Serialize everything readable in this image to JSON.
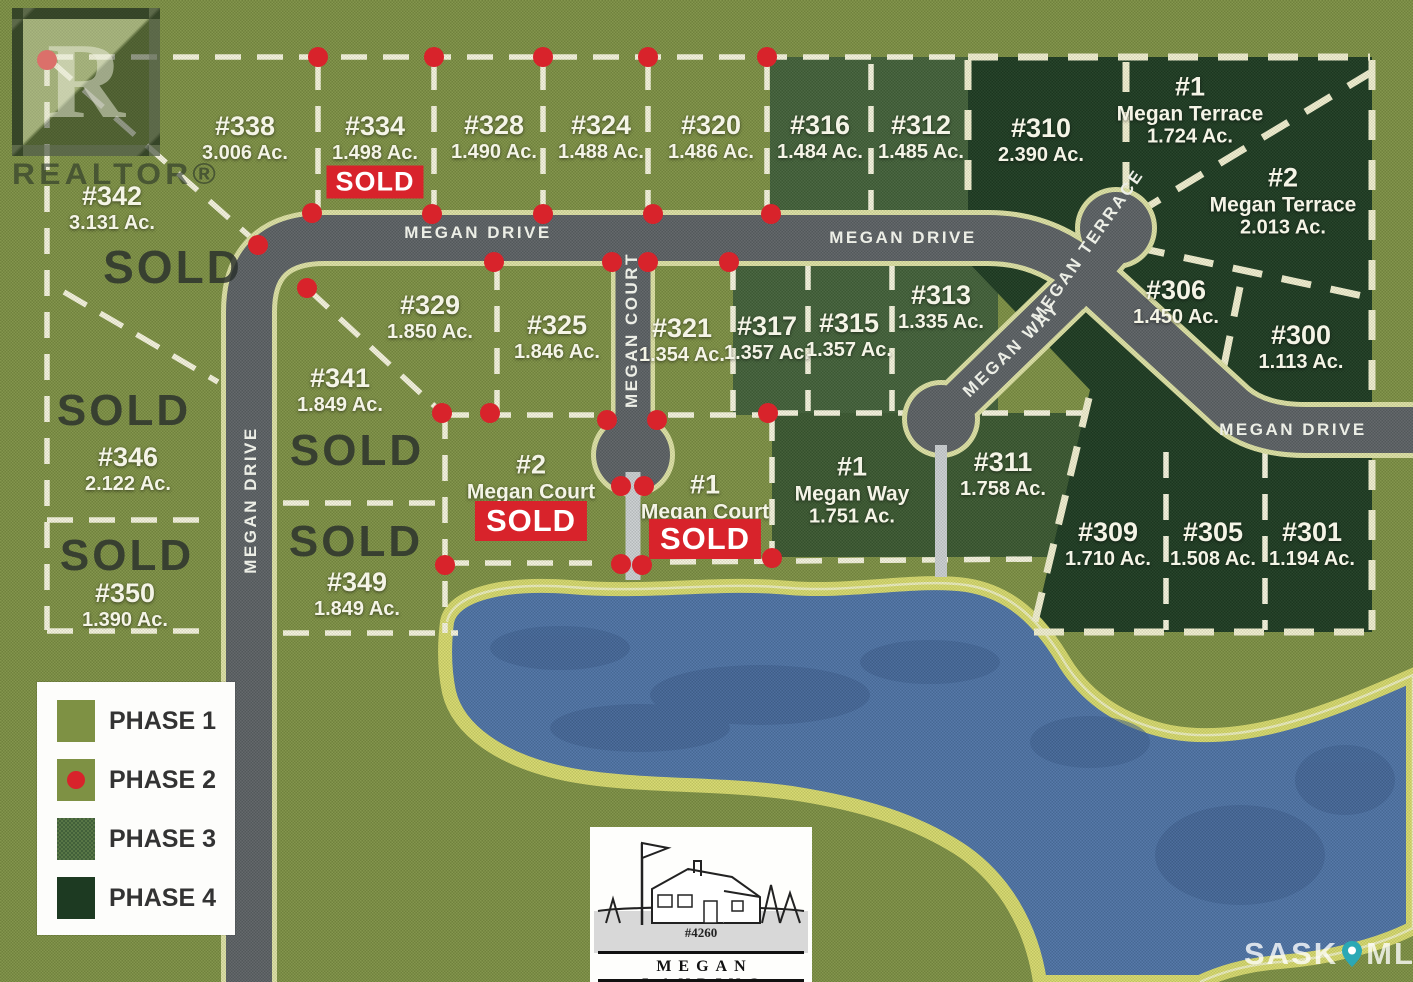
{
  "map": {
    "road_labels": [
      {
        "id": "megan-drive-top-left",
        "label": "MEGAN DRIVE",
        "x": 478,
        "y": 233,
        "rot": 0
      },
      {
        "id": "megan-drive-top-right",
        "label": "MEGAN DRIVE",
        "x": 903,
        "y": 238,
        "rot": 0
      },
      {
        "id": "megan-drive-right",
        "label": "MEGAN DRIVE",
        "x": 1293,
        "y": 430,
        "rot": 0
      },
      {
        "id": "megan-drive-west",
        "label": "MEGAN DRIVE",
        "x": 251,
        "y": 500,
        "rot": -90
      },
      {
        "id": "megan-court",
        "label": "MEGAN COURT",
        "x": 632,
        "y": 330,
        "rot": -90
      },
      {
        "id": "megan-way",
        "label": "MEGAN WAY",
        "x": 1012,
        "y": 350,
        "rot": -44
      },
      {
        "id": "megan-terrace",
        "label": "MEGAN TERRACE",
        "x": 1088,
        "y": 246,
        "rot": -55
      }
    ],
    "lots": [
      {
        "id": "342",
        "lines": [
          "#342",
          "3.131 Ac."
        ],
        "x": 112,
        "y": 208
      },
      {
        "id": "338",
        "lines": [
          "#338",
          "3.006 Ac."
        ],
        "x": 245,
        "y": 138
      },
      {
        "id": "334",
        "lines": [
          "#334",
          "1.498 Ac."
        ],
        "x": 375,
        "y": 138,
        "sold": "SOLD",
        "sold_dy": 44
      },
      {
        "id": "328",
        "lines": [
          "#328",
          "1.490 Ac."
        ],
        "x": 494,
        "y": 137
      },
      {
        "id": "324",
        "lines": [
          "#324",
          "1.488 Ac."
        ],
        "x": 601,
        "y": 137
      },
      {
        "id": "320",
        "lines": [
          "#320",
          "1.486 Ac."
        ],
        "x": 711,
        "y": 137
      },
      {
        "id": "316",
        "lines": [
          "#316",
          "1.484 Ac."
        ],
        "x": 820,
        "y": 137
      },
      {
        "id": "312",
        "lines": [
          "#312",
          "1.485 Ac."
        ],
        "x": 921,
        "y": 137
      },
      {
        "id": "310",
        "lines": [
          "#310",
          "2.390 Ac."
        ],
        "x": 1041,
        "y": 140
      },
      {
        "id": "1-megan-terrace",
        "lines": [
          "#1",
          "Megan Terrace",
          "1.724 Ac."
        ],
        "x": 1190,
        "y": 110
      },
      {
        "id": "2-megan-terrace",
        "lines": [
          "#2",
          "Megan Terrace",
          "2.013 Ac."
        ],
        "x": 1283,
        "y": 201
      },
      {
        "id": "329",
        "lines": [
          "#329",
          "1.850 Ac."
        ],
        "x": 430,
        "y": 317
      },
      {
        "id": "341",
        "lines": [
          "#341",
          "1.849 Ac."
        ],
        "x": 340,
        "y": 390
      },
      {
        "id": "325",
        "lines": [
          "#325",
          "1.846 Ac."
        ],
        "x": 557,
        "y": 337
      },
      {
        "id": "321",
        "lines": [
          "#321",
          "1.354 Ac."
        ],
        "x": 682,
        "y": 340
      },
      {
        "id": "317",
        "lines": [
          "#317",
          "1.357 Ac."
        ],
        "x": 767,
        "y": 338
      },
      {
        "id": "315",
        "lines": [
          "#315",
          "1.357 Ac."
        ],
        "x": 849,
        "y": 335
      },
      {
        "id": "313",
        "lines": [
          "#313",
          "1.335 Ac."
        ],
        "x": 941,
        "y": 307
      },
      {
        "id": "306",
        "lines": [
          "#306",
          "1.450 Ac."
        ],
        "x": 1176,
        "y": 302
      },
      {
        "id": "300",
        "lines": [
          "#300",
          "1.113 Ac."
        ],
        "x": 1301,
        "y": 347
      },
      {
        "id": "346",
        "lines": [
          "#346",
          "2.122 Ac."
        ],
        "x": 128,
        "y": 469
      },
      {
        "id": "350",
        "lines": [
          "#350",
          "1.390 Ac."
        ],
        "x": 125,
        "y": 605
      },
      {
        "id": "349",
        "lines": [
          "#349",
          "1.849 Ac."
        ],
        "x": 357,
        "y": 594
      },
      {
        "id": "2-megan-court",
        "lines": [
          "#2",
          "Megan Court"
        ],
        "x": 531,
        "y": 477,
        "sold": "SOLD",
        "sold_dy": 44,
        "sold_big": true
      },
      {
        "id": "1-megan-court",
        "lines": [
          "#1",
          "Megan Court"
        ],
        "x": 705,
        "y": 497,
        "sold": "SOLD",
        "sold_dy": 42,
        "sold_big": true
      },
      {
        "id": "1-megan-way",
        "lines": [
          "#1",
          "Megan Way",
          "1.751 Ac."
        ],
        "x": 852,
        "y": 490
      },
      {
        "id": "311",
        "lines": [
          "#311",
          "1.758 Ac."
        ],
        "x": 1003,
        "y": 474
      },
      {
        "id": "309",
        "lines": [
          "#309",
          "1.710 Ac."
        ],
        "x": 1108,
        "y": 544
      },
      {
        "id": "305",
        "lines": [
          "#305",
          "1.508 Ac."
        ],
        "x": 1213,
        "y": 544
      },
      {
        "id": "301",
        "lines": [
          "#301",
          "1.194 Ac."
        ],
        "x": 1312,
        "y": 544
      }
    ],
    "sold_overlays": [
      {
        "text": "SOLD",
        "x": 173,
        "y": 267,
        "size": 46
      },
      {
        "text": "SOLD",
        "x": 124,
        "y": 411,
        "size": 44
      },
      {
        "text": "SOLD",
        "x": 357,
        "y": 451,
        "size": 44
      },
      {
        "text": "SOLD",
        "x": 127,
        "y": 556,
        "size": 44
      },
      {
        "text": "SOLD",
        "x": 356,
        "y": 542,
        "size": 44
      }
    ],
    "phase2_dots": [
      [
        47,
        60
      ],
      [
        318,
        57
      ],
      [
        434,
        57
      ],
      [
        543,
        57
      ],
      [
        648,
        57
      ],
      [
        767,
        57
      ],
      [
        312,
        213
      ],
      [
        432,
        214
      ],
      [
        543,
        214
      ],
      [
        653,
        214
      ],
      [
        771,
        214
      ],
      [
        258,
        245
      ],
      [
        307,
        288
      ],
      [
        494,
        262
      ],
      [
        612,
        262
      ],
      [
        648,
        262
      ],
      [
        729,
        262
      ],
      [
        442,
        413
      ],
      [
        490,
        413
      ],
      [
        607,
        420
      ],
      [
        657,
        420
      ],
      [
        768,
        413
      ],
      [
        621,
        486
      ],
      [
        644,
        486
      ],
      [
        445,
        565
      ],
      [
        621,
        564
      ],
      [
        642,
        565
      ],
      [
        772,
        558
      ]
    ]
  },
  "legend": {
    "items": [
      {
        "label": "PHASE 1",
        "phase": "phase1"
      },
      {
        "label": "PHASE 2",
        "phase": "phase2"
      },
      {
        "label": "PHASE 3",
        "phase": "phase3"
      },
      {
        "label": "PHASE 4",
        "phase": "phase4"
      }
    ]
  },
  "branding": {
    "realtor_letter": "R",
    "realtor": "REALTOR®",
    "logo_number": "#4260",
    "logo_name": "MEGAN LANDING",
    "watermark_sask": "SASK",
    "watermark_mls": "MLS",
    "watermark_reg": "®"
  },
  "colors": {
    "phase1": "#7e9144",
    "phase2_marker": "#d8232b",
    "phase3": "#42603a",
    "phase4": "#1d3a22",
    "road": "#5c6166",
    "road_edge": "#dfe2a6",
    "lake": "#4e73a8",
    "lake_border": "#d8da6e",
    "sold_red": "#d8232b",
    "dash": "#f7f5e0"
  }
}
